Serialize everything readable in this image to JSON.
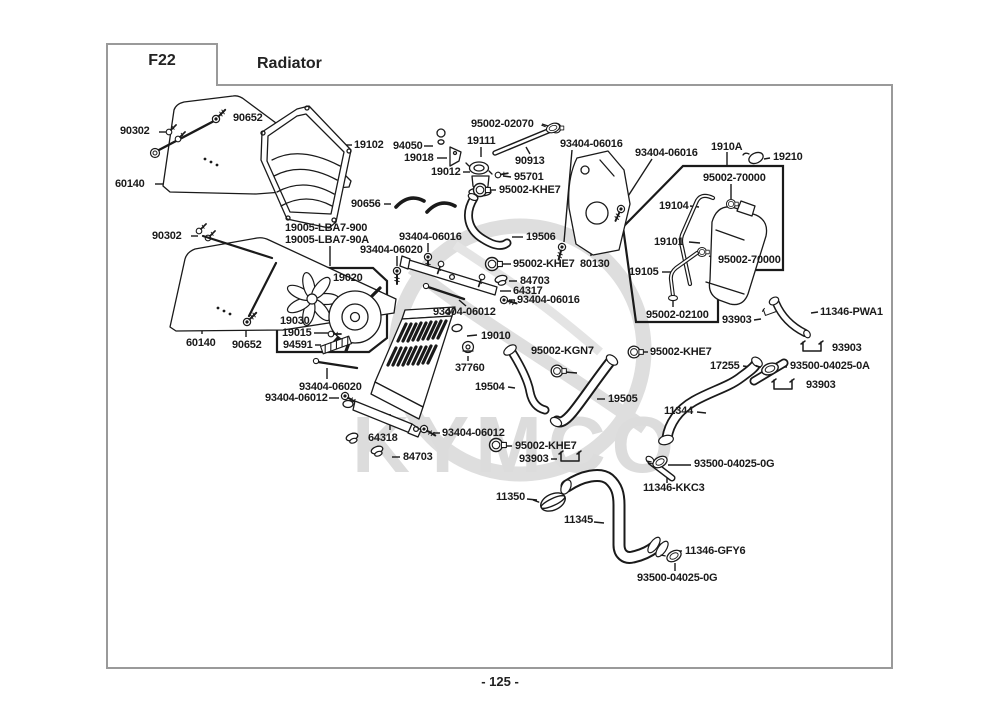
{
  "header": {
    "code": "F22",
    "title": "Radiator"
  },
  "footer": {
    "page_number": "- 125 -"
  },
  "watermark": "KYMCO",
  "labels": [
    {
      "text": "90652",
      "x": 233,
      "y": 112
    },
    {
      "text": "90302",
      "x": 120,
      "y": 125
    },
    {
      "text": "60140",
      "x": 115,
      "y": 178
    },
    {
      "text": "19102",
      "x": 354,
      "y": 139
    },
    {
      "text": "94050",
      "x": 393,
      "y": 140
    },
    {
      "text": "19018",
      "x": 404,
      "y": 152
    },
    {
      "text": "19012",
      "x": 431,
      "y": 166
    },
    {
      "text": "19111",
      "x": 467,
      "y": 135
    },
    {
      "text": "95002-02070",
      "x": 471,
      "y": 118
    },
    {
      "text": "90913",
      "x": 515,
      "y": 155
    },
    {
      "text": "95701",
      "x": 514,
      "y": 171
    },
    {
      "text": "95002-KHE7",
      "x": 499,
      "y": 184
    },
    {
      "text": "93404-06016",
      "x": 560,
      "y": 138
    },
    {
      "text": "93404-06016",
      "x": 635,
      "y": 147
    },
    {
      "text": "1910A",
      "x": 711,
      "y": 141
    },
    {
      "text": "19210",
      "x": 773,
      "y": 151
    },
    {
      "text": "95002-70000",
      "x": 703,
      "y": 172
    },
    {
      "text": "19104",
      "x": 659,
      "y": 200
    },
    {
      "text": "19101",
      "x": 654,
      "y": 236
    },
    {
      "text": "95002-70000",
      "x": 718,
      "y": 254
    },
    {
      "text": "19105",
      "x": 629,
      "y": 266
    },
    {
      "text": "95002-02100",
      "x": 646,
      "y": 309
    },
    {
      "text": "90302",
      "x": 152,
      "y": 230
    },
    {
      "text": "19005-LBA7-900",
      "x": 285,
      "y": 222
    },
    {
      "text": "19005-LBA7-90A",
      "x": 285,
      "y": 234
    },
    {
      "text": "90656",
      "x": 351,
      "y": 198
    },
    {
      "text": "93404-06016",
      "x": 399,
      "y": 231
    },
    {
      "text": "93404-06020",
      "x": 360,
      "y": 244
    },
    {
      "text": "19506",
      "x": 526,
      "y": 231
    },
    {
      "text": "95002-KHE7",
      "x": 513,
      "y": 258
    },
    {
      "text": "80130",
      "x": 580,
      "y": 258
    },
    {
      "text": "84703",
      "x": 520,
      "y": 275
    },
    {
      "text": "64317",
      "x": 513,
      "y": 285
    },
    {
      "text": "93404-06016",
      "x": 517,
      "y": 294
    },
    {
      "text": "93404-06012",
      "x": 433,
      "y": 306
    },
    {
      "text": "19020",
      "x": 333,
      "y": 272
    },
    {
      "text": "19030",
      "x": 280,
      "y": 315
    },
    {
      "text": "19015",
      "x": 282,
      "y": 327
    },
    {
      "text": "94591",
      "x": 283,
      "y": 339
    },
    {
      "text": "60140",
      "x": 186,
      "y": 337
    },
    {
      "text": "90652",
      "x": 232,
      "y": 339
    },
    {
      "text": "19010",
      "x": 481,
      "y": 330
    },
    {
      "text": "37760",
      "x": 455,
      "y": 362
    },
    {
      "text": "95002-KGN7",
      "x": 531,
      "y": 345
    },
    {
      "text": "19504",
      "x": 475,
      "y": 381
    },
    {
      "text": "93404-06020",
      "x": 299,
      "y": 381
    },
    {
      "text": "93404-06012",
      "x": 265,
      "y": 392
    },
    {
      "text": "64318",
      "x": 368,
      "y": 432
    },
    {
      "text": "93404-06012",
      "x": 442,
      "y": 427
    },
    {
      "text": "84703",
      "x": 403,
      "y": 451
    },
    {
      "text": "95002-KHE7",
      "x": 515,
      "y": 440
    },
    {
      "text": "93903",
      "x": 519,
      "y": 453
    },
    {
      "text": "19505",
      "x": 608,
      "y": 393
    },
    {
      "text": "11344",
      "x": 664,
      "y": 405
    },
    {
      "text": "95002-KHE7",
      "x": 650,
      "y": 346
    },
    {
      "text": "93903",
      "x": 722,
      "y": 314
    },
    {
      "text": "11346-PWA1",
      "x": 820,
      "y": 306
    },
    {
      "text": "93903",
      "x": 832,
      "y": 342
    },
    {
      "text": "17255",
      "x": 710,
      "y": 360
    },
    {
      "text": "93500-04025-0A",
      "x": 790,
      "y": 360
    },
    {
      "text": "93903",
      "x": 806,
      "y": 379
    },
    {
      "text": "93500-04025-0G",
      "x": 694,
      "y": 458
    },
    {
      "text": "11346-KKC3",
      "x": 643,
      "y": 482
    },
    {
      "text": "11350",
      "x": 496,
      "y": 491
    },
    {
      "text": "11345",
      "x": 564,
      "y": 514
    },
    {
      "text": "11346-GFY6",
      "x": 685,
      "y": 545
    },
    {
      "text": "93500-04025-0G",
      "x": 637,
      "y": 572
    }
  ]
}
